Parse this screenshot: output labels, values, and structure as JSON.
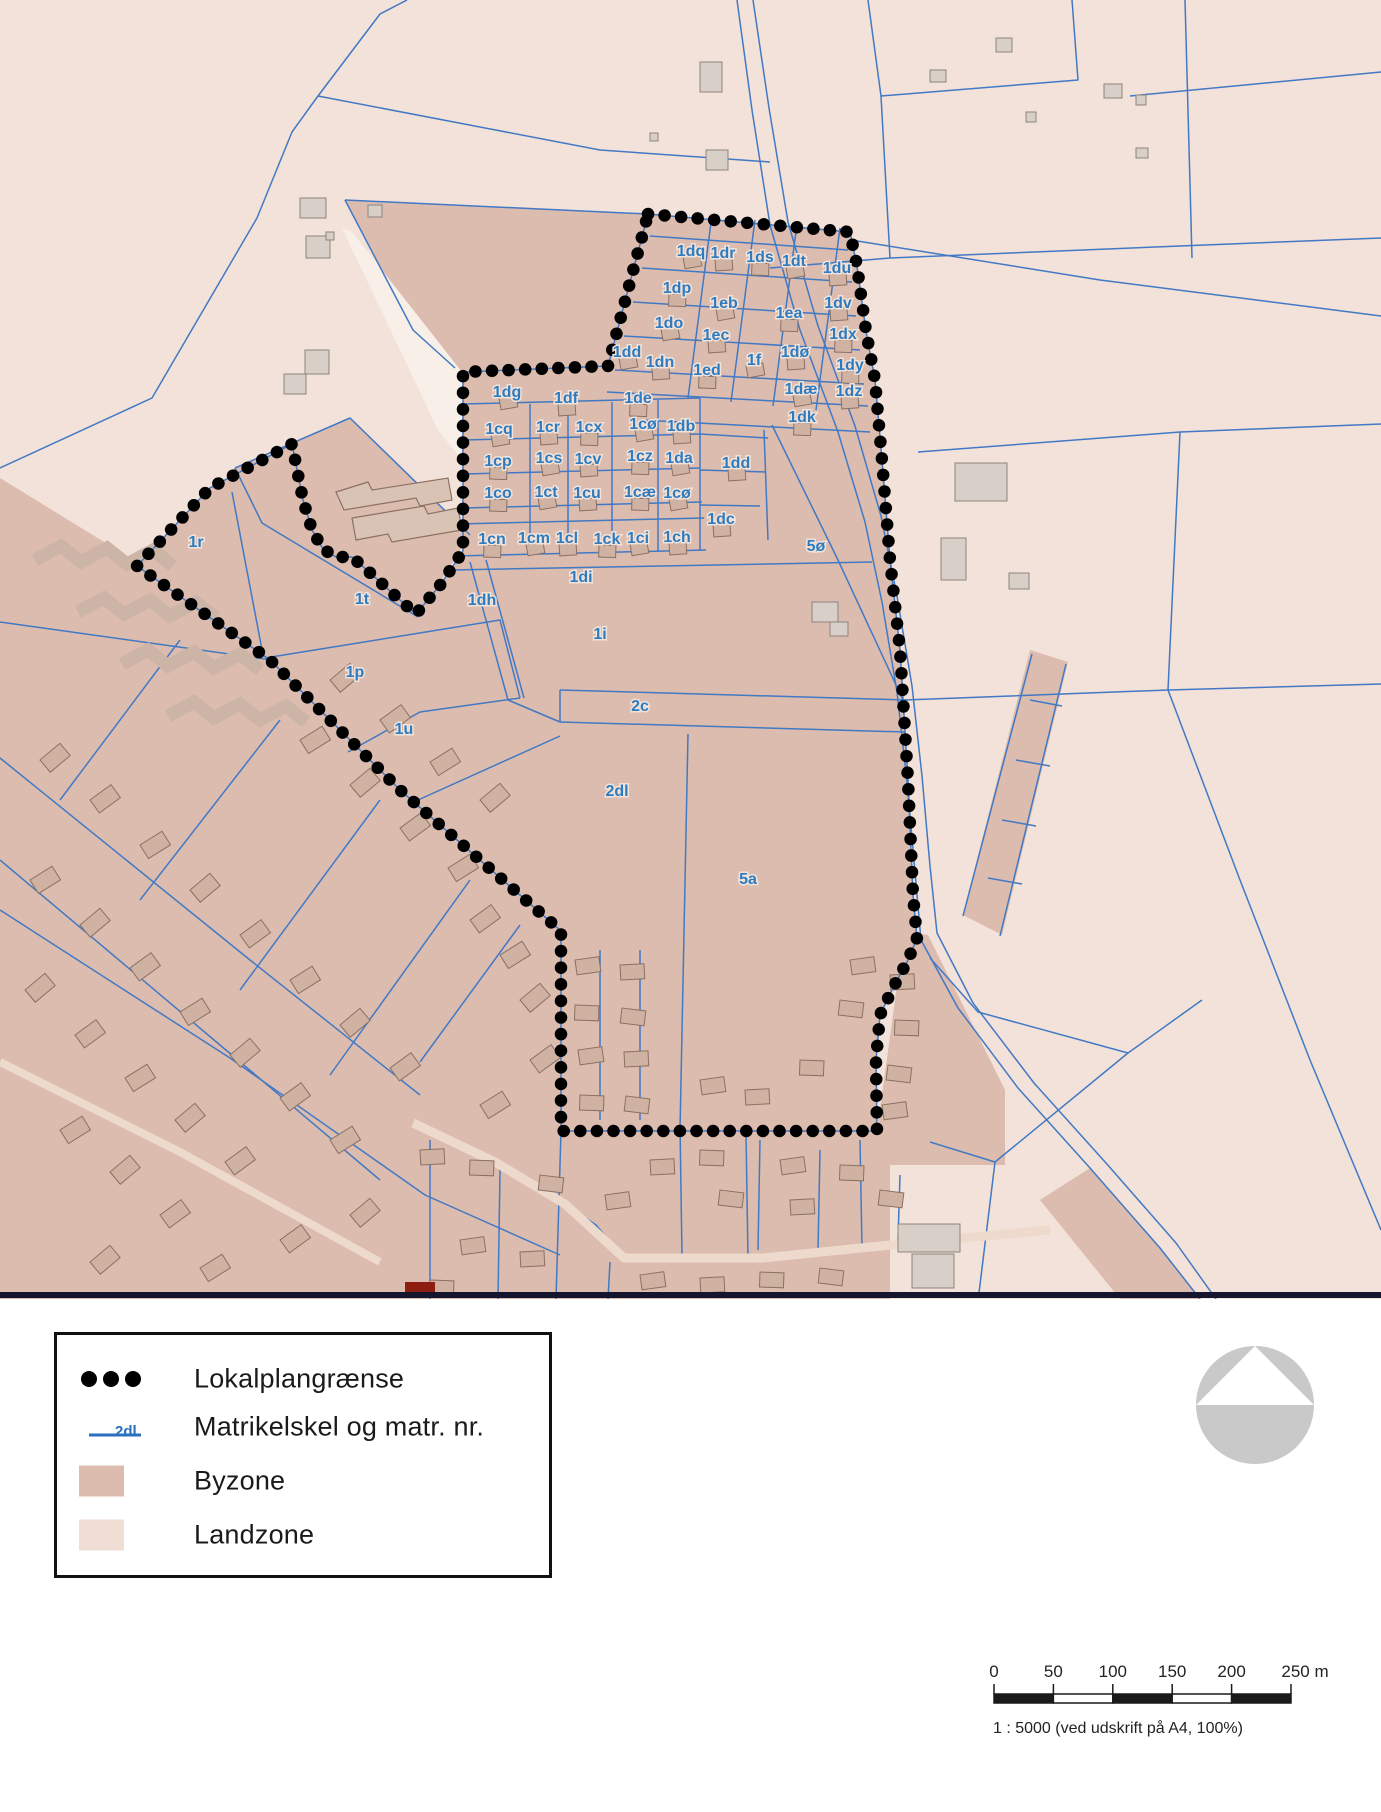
{
  "colors": {
    "landzone": "#f3e2d9",
    "byzone": "#dcbcae",
    "blue_line": "#4179c5",
    "label_blue": "#2e7bbf",
    "label_halo": "#f2e3da",
    "boundary_dot": "#000000",
    "building_fill": "#cfb2a2",
    "building_stroke": "#8a7163",
    "gray_building_fill": "#d7cfc8",
    "gray_building_stroke": "#8d857d",
    "divider": "#15152e",
    "red_building": "#8e1d12",
    "north_arrow_gray": "#c9c9c9"
  },
  "map": {
    "parcel_labels": [
      {
        "t": "1dq",
        "x": 691,
        "y": 251
      },
      {
        "t": "1dr",
        "x": 723,
        "y": 253
      },
      {
        "t": "1ds",
        "x": 760,
        "y": 257
      },
      {
        "t": "1dt",
        "x": 794,
        "y": 261
      },
      {
        "t": "1du",
        "x": 837,
        "y": 268
      },
      {
        "t": "1dp",
        "x": 677,
        "y": 288
      },
      {
        "t": "1eb",
        "x": 724,
        "y": 303
      },
      {
        "t": "1dv",
        "x": 838,
        "y": 303
      },
      {
        "t": "1ea",
        "x": 789,
        "y": 313
      },
      {
        "t": "1do",
        "x": 669,
        "y": 323
      },
      {
        "t": "1ec",
        "x": 716,
        "y": 335
      },
      {
        "t": "1dx",
        "x": 843,
        "y": 334
      },
      {
        "t": "1dd",
        "x": 627,
        "y": 352
      },
      {
        "t": "1dn",
        "x": 660,
        "y": 362
      },
      {
        "t": "1ed",
        "x": 707,
        "y": 370
      },
      {
        "t": "1f",
        "x": 754,
        "y": 360
      },
      {
        "t": "1dø",
        "x": 795,
        "y": 352
      },
      {
        "t": "1dy",
        "x": 850,
        "y": 365
      },
      {
        "t": "1dæ",
        "x": 801,
        "y": 389
      },
      {
        "t": "1dz",
        "x": 849,
        "y": 391
      },
      {
        "t": "1dk",
        "x": 802,
        "y": 417
      },
      {
        "t": "1dg",
        "x": 507,
        "y": 392
      },
      {
        "t": "1df",
        "x": 566,
        "y": 398
      },
      {
        "t": "1de",
        "x": 638,
        "y": 398
      },
      {
        "t": "1cq",
        "x": 499,
        "y": 429
      },
      {
        "t": "1cr",
        "x": 548,
        "y": 427
      },
      {
        "t": "1cx",
        "x": 589,
        "y": 427
      },
      {
        "t": "1cø",
        "x": 643,
        "y": 424
      },
      {
        "t": "1db",
        "x": 681,
        "y": 426
      },
      {
        "t": "1cp",
        "x": 498,
        "y": 461
      },
      {
        "t": "1cs",
        "x": 549,
        "y": 458
      },
      {
        "t": "1cv",
        "x": 588,
        "y": 459
      },
      {
        "t": "1cz",
        "x": 640,
        "y": 456
      },
      {
        "t": "1da",
        "x": 679,
        "y": 458
      },
      {
        "t": "1dd",
        "x": 736,
        "y": 463
      },
      {
        "t": "1co",
        "x": 498,
        "y": 493
      },
      {
        "t": "1ct",
        "x": 546,
        "y": 492
      },
      {
        "t": "1cu",
        "x": 587,
        "y": 493
      },
      {
        "t": "1cæ",
        "x": 640,
        "y": 492
      },
      {
        "t": "1cø",
        "x": 677,
        "y": 493
      },
      {
        "t": "1dc",
        "x": 721,
        "y": 519
      },
      {
        "t": "1cn",
        "x": 492,
        "y": 539
      },
      {
        "t": "1cm",
        "x": 534,
        "y": 538
      },
      {
        "t": "1cl",
        "x": 567,
        "y": 538
      },
      {
        "t": "1ck",
        "x": 607,
        "y": 539
      },
      {
        "t": "1ci",
        "x": 638,
        "y": 538
      },
      {
        "t": "1ch",
        "x": 677,
        "y": 537
      },
      {
        "t": "5ø",
        "x": 816,
        "y": 546
      },
      {
        "t": "1di",
        "x": 581,
        "y": 577
      },
      {
        "t": "1dh",
        "x": 482,
        "y": 600
      },
      {
        "t": "1r",
        "x": 196,
        "y": 542
      },
      {
        "t": "1t",
        "x": 362,
        "y": 599
      },
      {
        "t": "1p",
        "x": 355,
        "y": 672
      },
      {
        "t": "1u",
        "x": 404,
        "y": 729
      },
      {
        "t": "1i",
        "x": 600,
        "y": 634
      },
      {
        "t": "2c",
        "x": 640,
        "y": 706
      },
      {
        "t": "2dl",
        "x": 617,
        "y": 791
      },
      {
        "t": "5a",
        "x": 748,
        "y": 879
      }
    ]
  },
  "legend": {
    "items": [
      {
        "label": "Lokalplangrænse"
      },
      {
        "label": "Matrikelskel og matr. nr.",
        "matr_nr": "2dl"
      },
      {
        "label": "Byzone"
      },
      {
        "label": "Landzone"
      }
    ]
  },
  "scalebar": {
    "ticks": [
      "0",
      "50",
      "100",
      "150",
      "200",
      "250 m"
    ],
    "caption": "1 : 5000 (ved udskrift på A4, 100%)"
  }
}
